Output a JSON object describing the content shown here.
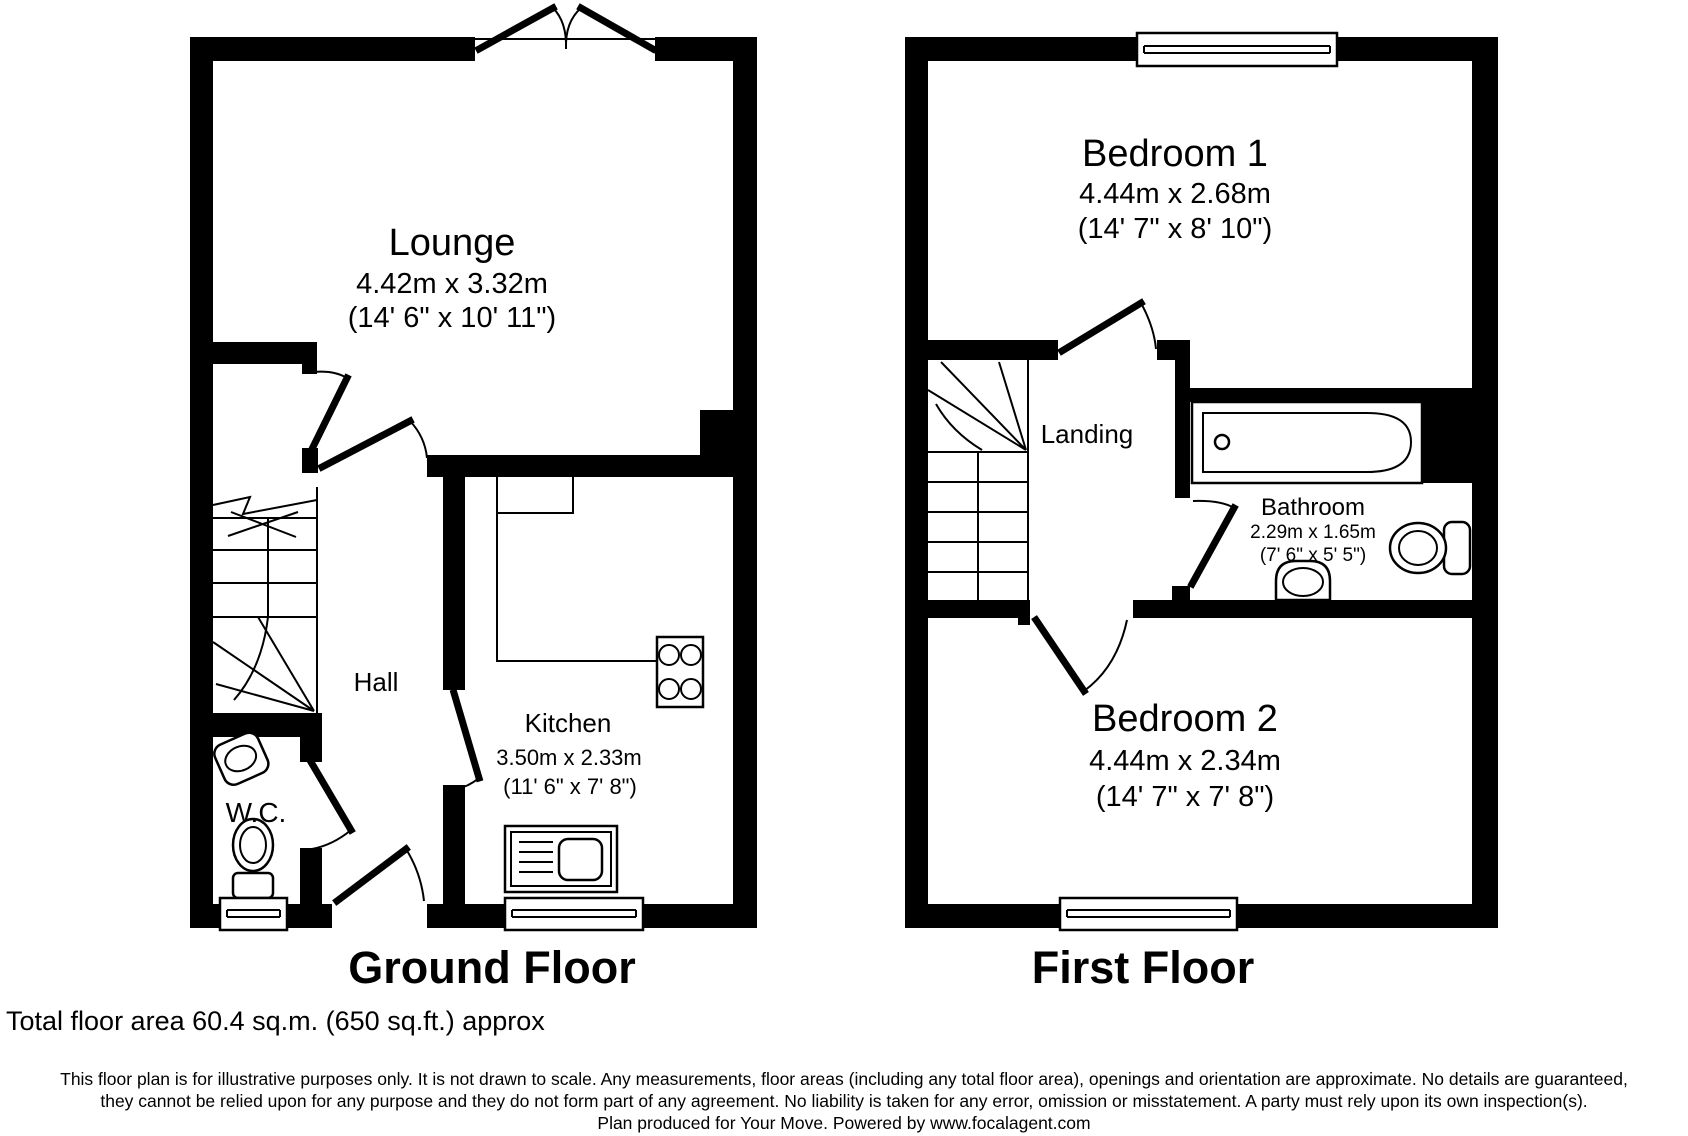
{
  "floors": {
    "ground": {
      "title": "Ground Floor",
      "rooms": {
        "lounge": {
          "name": "Lounge",
          "metric": "4.42m x 3.32m",
          "imperial": "(14' 6\" x 10' 11\")"
        },
        "hall": {
          "name": "Hall"
        },
        "wc": {
          "name": "W.C."
        },
        "kitchen": {
          "name": "Kitchen",
          "metric": "3.50m x 2.33m",
          "imperial": "(11' 6\" x 7' 8\")"
        }
      }
    },
    "first": {
      "title": "First Floor",
      "rooms": {
        "bedroom1": {
          "name": "Bedroom 1",
          "metric": "4.44m x 2.68m",
          "imperial": "(14' 7\" x 8' 10\")"
        },
        "landing": {
          "name": "Landing"
        },
        "bathroom": {
          "name": "Bathroom",
          "metric": "2.29m x 1.65m",
          "imperial": "(7' 6\" x 5' 5\")"
        },
        "bedroom2": {
          "name": "Bedroom 2",
          "metric": "4.44m x 2.34m",
          "imperial": "(14' 7\" x 7' 8\")"
        }
      }
    }
  },
  "footer": {
    "total_area": "Total floor area 60.4 sq.m. (650 sq.ft.) approx",
    "disclaimer_line1": "This floor plan is for illustrative purposes only. It is not drawn to scale. Any measurements, floor areas (including any total floor area), openings and orientation are approximate. No details are guaranteed,",
    "disclaimer_line2": "they cannot be relied upon for any purpose and they do not form part of any agreement. No liability is taken for any error, omission or misstatement. A party must rely upon its own inspection(s).",
    "disclaimer_line3": "Plan produced for Your Move. Powered by www.focalagent.com"
  },
  "colors": {
    "wall": "#000000",
    "background": "#ffffff"
  }
}
